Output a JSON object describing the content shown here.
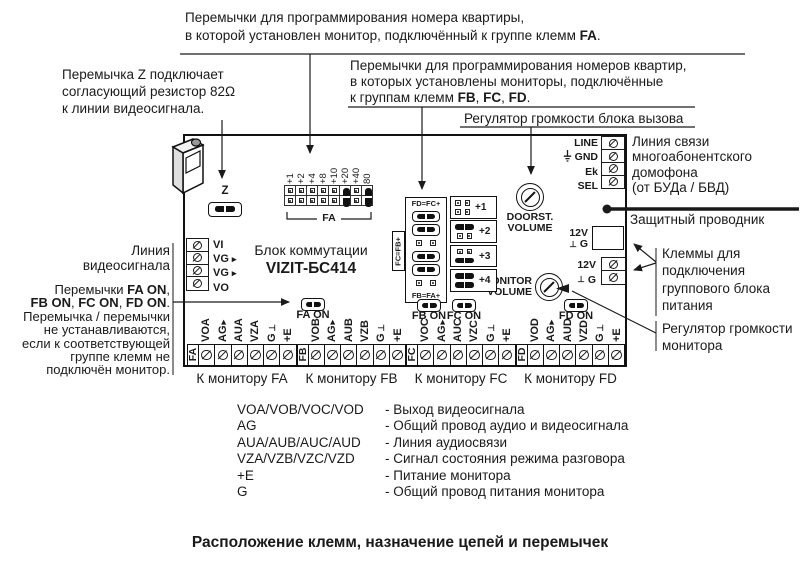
{
  "title": "Расположение клемм, назначение цепей и перемычек",
  "colors": {
    "ink": "#1a1a1a",
    "background": "#ffffff"
  },
  "board": {
    "name_line1": "Блок коммутации",
    "name_line2": "VIZIT-БС414",
    "video_terminals": [
      {
        "label": "VI",
        "arrow": false
      },
      {
        "label": "VG",
        "arrow": true
      },
      {
        "label": "VG",
        "arrow": true
      },
      {
        "label": "VO",
        "arrow": false
      }
    ],
    "bus_terminals": [
      {
        "label": "LINE",
        "gnd": false
      },
      {
        "label": "GND",
        "gnd": true
      },
      {
        "label": "Ek",
        "gnd": false
      },
      {
        "label": "SEL",
        "gnd": false
      }
    ],
    "power_socket_labels": [
      {
        "label": "12V",
        "perp": false
      },
      {
        "label": "G",
        "perp": true
      }
    ],
    "power_screw_labels": [
      {
        "label": "12V",
        "perp": false
      },
      {
        "label": "G",
        "perp": true
      }
    ],
    "fa_block": {
      "pin_labels": [
        "+1",
        "+2",
        "+4",
        "+8",
        "+10",
        "+20",
        "+40",
        "80"
      ],
      "jumpered": [
        false,
        false,
        false,
        false,
        false,
        true,
        false,
        true
      ],
      "bracket_label": "FA"
    },
    "offset_block": {
      "left_rows": [
        {
          "type": "label",
          "text": "FD=FC+"
        },
        {
          "type": "jumper"
        },
        {
          "type": "jumper"
        },
        {
          "type": "open"
        },
        {
          "type": "jumper"
        },
        {
          "type": "jumper"
        },
        {
          "type": "open"
        },
        {
          "type": "label",
          "text": "FB=FA+"
        }
      ],
      "side_label": "FC=FB+",
      "right_blocks": [
        {
          "label": "+1",
          "rows": [
            "open",
            "open"
          ]
        },
        {
          "label": "+2",
          "rows": [
            "jumper",
            "open"
          ]
        },
        {
          "label": "+3",
          "rows": [
            "open",
            "jumper"
          ]
        },
        {
          "label": "+4",
          "rows": [
            "jumper",
            "jumper"
          ]
        }
      ]
    },
    "pots": [
      {
        "label1": "DOORST.",
        "label2": "VOLUME"
      },
      {
        "label1": "MONITOR",
        "label2": "VOLUME"
      }
    ],
    "z_jumper_label": "Z",
    "on_jumpers": [
      {
        "label": "FA ON"
      },
      {
        "label": "FB ON"
      },
      {
        "label": "FC ON"
      },
      {
        "label": "FD ON"
      }
    ],
    "monitor_groups": [
      {
        "group": "FA",
        "caption": "К монитору FA",
        "terminals": [
          {
            "label": "VOA"
          },
          {
            "label": "AG",
            "sym": "arrow"
          },
          {
            "label": "AUA"
          },
          {
            "label": "VZA"
          },
          {
            "label": "G",
            "sym": "perp"
          },
          {
            "label": "+E"
          }
        ]
      },
      {
        "group": "FB",
        "caption": "К монитору FB",
        "terminals": [
          {
            "label": "VOB"
          },
          {
            "label": "AG",
            "sym": "arrow"
          },
          {
            "label": "AUB"
          },
          {
            "label": "VZB"
          },
          {
            "label": "G",
            "sym": "perp"
          },
          {
            "label": "+E"
          }
        ]
      },
      {
        "group": "FC",
        "caption": "К монитору FC",
        "terminals": [
          {
            "label": "VOC"
          },
          {
            "label": "AG",
            "sym": "arrow"
          },
          {
            "label": "AUC"
          },
          {
            "label": "VZC"
          },
          {
            "label": "G",
            "sym": "perp"
          },
          {
            "label": "+E"
          }
        ]
      },
      {
        "group": "FD",
        "caption": "К монитору FD",
        "terminals": [
          {
            "label": "VOD"
          },
          {
            "label": "AG",
            "sym": "arrow"
          },
          {
            "label": "AUD"
          },
          {
            "label": "VZD"
          },
          {
            "label": "G",
            "sym": "perp"
          },
          {
            "label": "+E"
          }
        ]
      }
    ]
  },
  "annotations": {
    "fa_note": [
      {
        "t": "Перемычки для программирования номера квартиры,"
      },
      {
        "br": true
      },
      {
        "t": "в которой установлен монитор, подключённый к группе клемм "
      },
      {
        "t": "FA",
        "b": true
      },
      {
        "t": "."
      }
    ],
    "fbcd_note": [
      {
        "t": "Перемычки для программирования номеров квартир,"
      },
      {
        "br": true
      },
      {
        "t": "в которых установлены мониторы, подключённые"
      },
      {
        "br": true
      },
      {
        "t": "к группам клемм "
      },
      {
        "t": "FB",
        "b": true
      },
      {
        "t": ", "
      },
      {
        "t": "FC",
        "b": true
      },
      {
        "t": ", "
      },
      {
        "t": "FD",
        "b": true
      },
      {
        "t": "."
      }
    ],
    "call_volume_note": [
      {
        "t": "Регулятор громкости блока вызова"
      }
    ],
    "z_note": [
      {
        "t": "Перемычка Z подключает"
      },
      {
        "br": true
      },
      {
        "t": "согласующий резистор 82Ω"
      },
      {
        "br": true
      },
      {
        "t": "к линии видеосигнала."
      }
    ],
    "video_line_note": [
      {
        "t": "Линия"
      },
      {
        "br": true
      },
      {
        "t": "видеосигнала"
      }
    ],
    "on_jumpers_note": [
      {
        "t": "Перемычки "
      },
      {
        "t": "FA ON",
        "b": true
      },
      {
        "t": ","
      },
      {
        "br": true
      },
      {
        "t": "FB ON",
        "b": true
      },
      {
        "t": ", "
      },
      {
        "t": "FC ON",
        "b": true
      },
      {
        "t": ", "
      },
      {
        "t": "FD ON",
        "b": true
      },
      {
        "t": "."
      },
      {
        "br": true
      },
      {
        "t": "Перемычка / перемычки"
      },
      {
        "br": true
      },
      {
        "t": "не устанавливаются,"
      },
      {
        "br": true
      },
      {
        "t": "если к соответствующей"
      },
      {
        "br": true
      },
      {
        "t": "группе клемм не"
      },
      {
        "br": true
      },
      {
        "t": "подключён монитор."
      }
    ],
    "bus_line_note": [
      {
        "t": "Линия связи"
      },
      {
        "br": true
      },
      {
        "t": "многоабонентского"
      },
      {
        "br": true
      },
      {
        "t": "домофона"
      },
      {
        "br": true
      },
      {
        "t": "(от БУДа / БВД)"
      }
    ],
    "protective_note": [
      {
        "t": "Защитный проводник"
      }
    ],
    "psu_note": [
      {
        "t": "Клеммы для"
      },
      {
        "br": true
      },
      {
        "t": "подключения"
      },
      {
        "br": true
      },
      {
        "t": "группового блока"
      },
      {
        "br": true
      },
      {
        "t": "питания"
      }
    ],
    "mv_note": [
      {
        "t": "Регулятор громкости"
      },
      {
        "br": true
      },
      {
        "t": "монитора"
      }
    ]
  },
  "legend": [
    {
      "term": "VOA/VOB/VOC/VOD",
      "desc": "- Выход видеосигнала"
    },
    {
      "term": "AG",
      "desc": "- Общий провод аудио и видеосигнала"
    },
    {
      "term": "AUA/AUB/AUC/AUD",
      "desc": "- Линия аудиосвязи"
    },
    {
      "term": "VZA/VZB/VZC/VZD",
      "desc": "- Сигнал состояния режима разговора"
    },
    {
      "term": "+E",
      "desc": "- Питание монитора"
    },
    {
      "term": "G",
      "desc": "- Общий провод питания монитора"
    }
  ]
}
